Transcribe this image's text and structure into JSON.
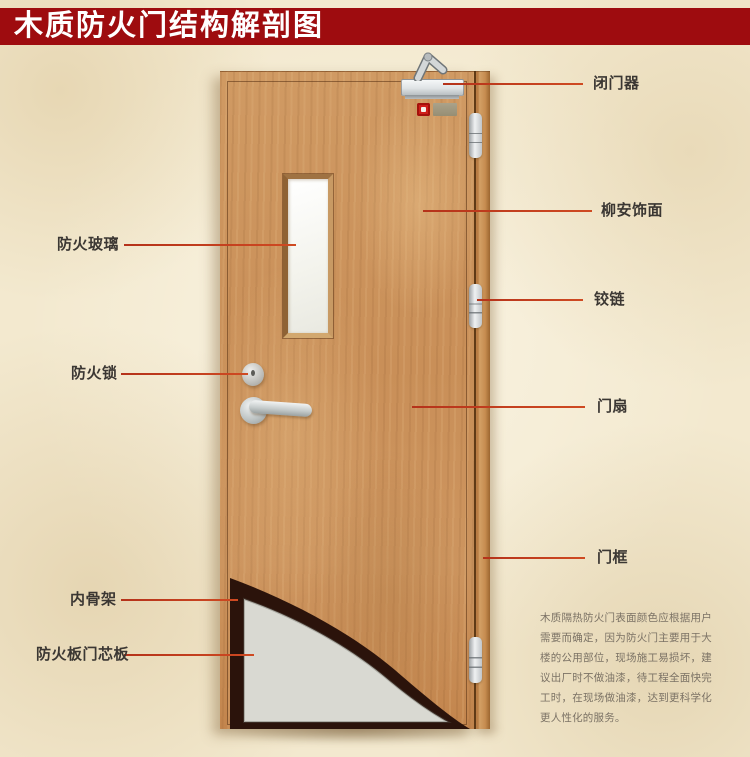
{
  "title": "木质防火门结构解剖图",
  "annotations": {
    "left": [
      {
        "id": "fire-glass",
        "text": "防火玻璃"
      },
      {
        "id": "fire-lock",
        "text": "防火锁"
      },
      {
        "id": "inner-skeleton",
        "text": "内骨架"
      },
      {
        "id": "fire-board-core",
        "text": "防火板门芯板"
      }
    ],
    "right": [
      {
        "id": "door-closer",
        "text": "闭门器"
      },
      {
        "id": "lauan-veneer",
        "text": "柳安饰面"
      },
      {
        "id": "hinge",
        "text": "铰链"
      },
      {
        "id": "door-leaf",
        "text": "门扇"
      },
      {
        "id": "door-frame",
        "text": "门框"
      }
    ]
  },
  "description": "木质隔热防火门表面颜色应根据用户需要而确定，因为防火门主要用于大楼的公用部位，现场施工易损坏，建议出厂时不做油漆，待工程全面快完工时，在现场做油漆，达到更科学化更人性化的服务。",
  "colors": {
    "banner_red": "#9e0c0f",
    "leader_line_red": "#c23b1b",
    "label_text": "#3b3733",
    "description_text": "#7b7265",
    "wood": "#cd955f",
    "core_board_gray": "#d9d9d2",
    "cutaway_dark": "#2b130b",
    "background_paper": "#f3e9cf"
  }
}
